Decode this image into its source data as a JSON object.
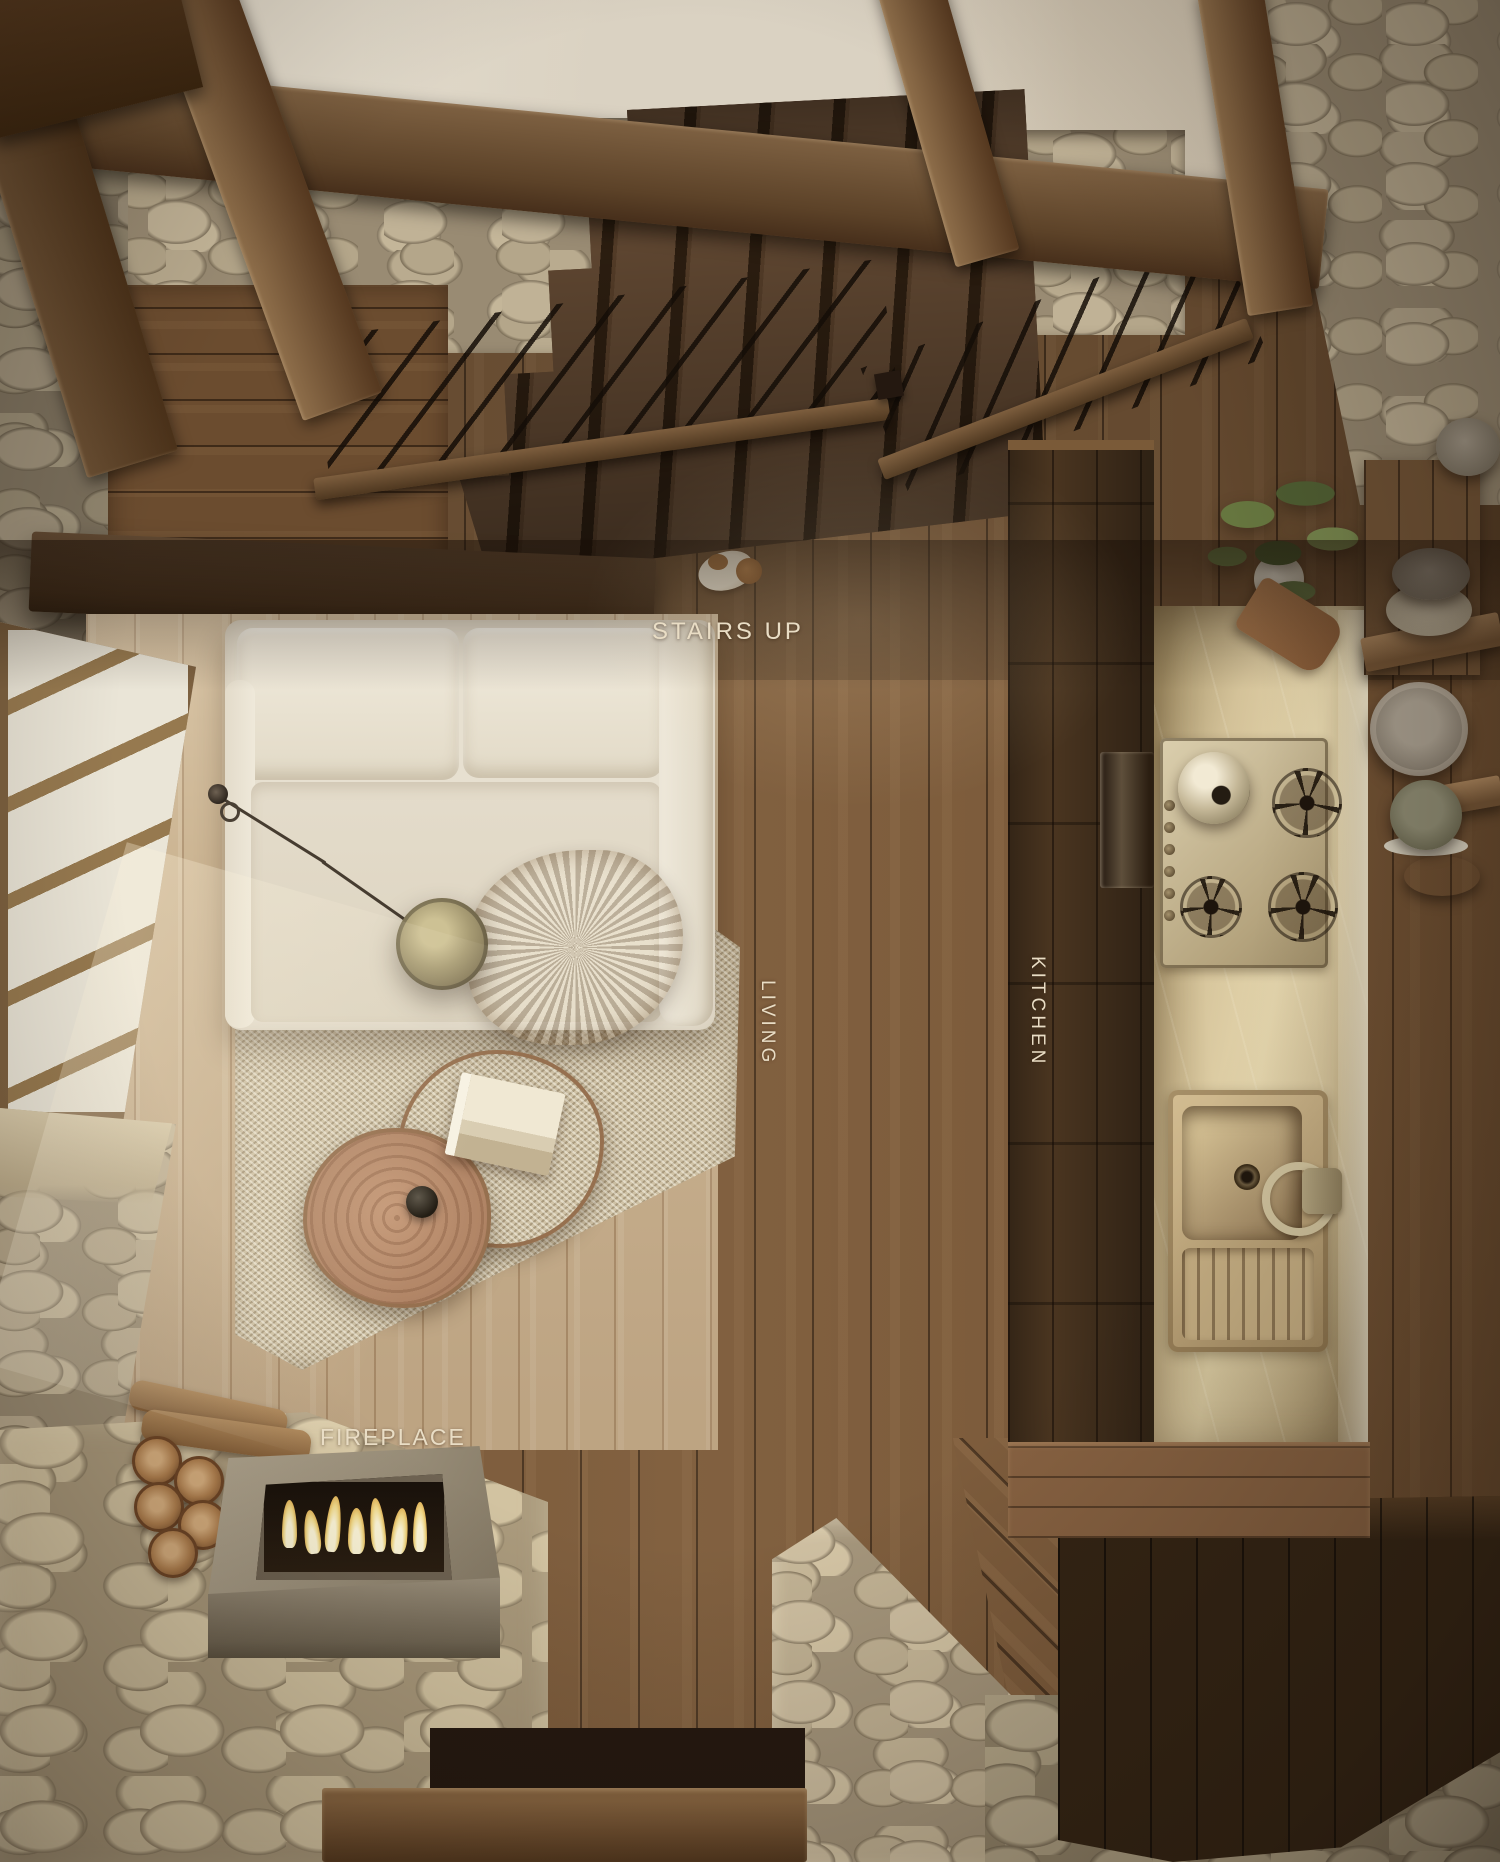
{
  "image_type": "top-down 3D render of a rustic stone-and-timber cabin interior",
  "room_labels": {
    "stairs_up": "STAIRS UP",
    "living": "LIVING",
    "kitchen": "KITCHEN",
    "fireplace": "FIREPLACE"
  },
  "label_color": "#e9ddc5",
  "palette": {
    "ceiling_plaster": "#d7cdba",
    "beam_wood": "#6e5338",
    "stair_wood": "#4e3824",
    "floor_mid_wood": "#7a5939",
    "floor_pale_wood": "#ccb593",
    "stone_wall": "#998b73",
    "stone_floor": "#c8b897",
    "sofa_cream": "#e7e0d0",
    "rug_beige": "#cfc2a6",
    "counter_marble": "#c0ad83",
    "firepit_metal": "#968b76",
    "flame": "#f5de8e"
  }
}
